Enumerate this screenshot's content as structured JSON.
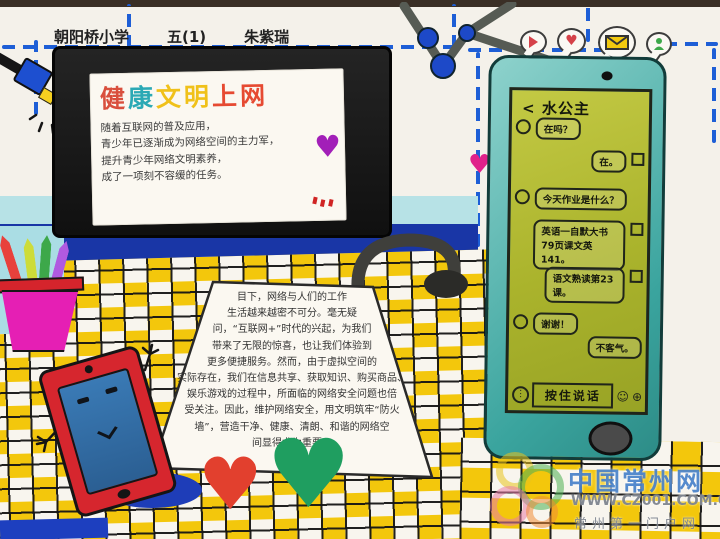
{
  "header": {
    "school": "朝阳桥小学",
    "class_name": "五(1)",
    "student": "朱紫瑞"
  },
  "tv": {
    "title_chars": [
      {
        "ch": "健",
        "color": "#d94f3d"
      },
      {
        "ch": "康",
        "color": "#2ba9b5"
      },
      {
        "ch": "文",
        "color": "#f0c11a"
      },
      {
        "ch": "明",
        "color": "#f0c11a"
      },
      {
        "ch": "上",
        "color": "#e64a32"
      },
      {
        "ch": "网",
        "color": "#e64a32"
      }
    ],
    "lines": [
      "随着互联网的普及应用，",
      "青少年已逐渐成为网络空间的主力军，",
      "提升青少年网络文明素养，",
      "成了一项刻不容缓的任务。"
    ]
  },
  "note": {
    "lines": [
      "目下，网络与人们的工作",
      "生活越来越密不可分。毫无疑",
      "问，“互联网+”时代的兴起，为我们",
      "带来了无限的惊喜，也让我们体验到",
      "更多便捷服务。然而，由于虚拟空间的",
      "实际存在，我们在信息共享、获取知识、购买商品、",
      "娱乐游戏的过程中，所面临的网络安全问题也倍",
      "受关注。因此，维护网络安全，用文明筑牢“防火",
      "墙”，营造干净、健康、清朗、和谐的网络空",
      "间显得尤为重要。"
    ]
  },
  "phone": {
    "back_glyph": "<",
    "contact": "水公主",
    "messages": [
      {
        "side": "left",
        "text": "在吗？"
      },
      {
        "side": "right",
        "text": "在。"
      },
      {
        "side": "left",
        "text": "今天作业是什么？"
      },
      {
        "side": "right",
        "text": "英语一自默大书79页课文英141。"
      },
      {
        "side": "right",
        "text": "语文熟读第23课。"
      },
      {
        "side": "left",
        "text": "谢谢！"
      },
      {
        "side": "right",
        "text": "不客气。"
      }
    ],
    "input_label": "按住说话",
    "icons": {
      "speaker": "⋮",
      "smiley": "☺",
      "plus": "⊕"
    }
  },
  "shapes": {
    "heart": "♥"
  },
  "icons": {
    "top_right": [
      "play-bubble-icon",
      "heart-bubble-icon",
      "mail-bubble-icon",
      "person-bubble-icon"
    ]
  },
  "watermark": {
    "site": "中国常州网",
    "url": "WWW.CZ001.COM.CN",
    "tagline": "常州第一门户网"
  },
  "colors": {
    "dashed_blue": "#1d5ed6",
    "checker_yellow": "#f3c70c",
    "band_blue": "#1936a6",
    "band_cyan": "#b7e2e6",
    "phone_body_teal": "#3aa49e",
    "phone_screen_olive": "#aab32c",
    "tablet_red": "#d6262e",
    "tablet_screen_blue": "#2f6fa3",
    "heart_red": "#e2402e",
    "heart_green": "#1f9e60",
    "heart_purple": "#a21fb8",
    "heart_pink": "#e0218a",
    "cup_magenta": "#e51fb4",
    "cup_rim_red": "#d5242c",
    "lamp_shade_blue": "#1d4fd0",
    "lamp_light_yellow": "#f5d020",
    "node_blue": "#1d49c8",
    "watermark_blue": "#3e7ac6"
  }
}
